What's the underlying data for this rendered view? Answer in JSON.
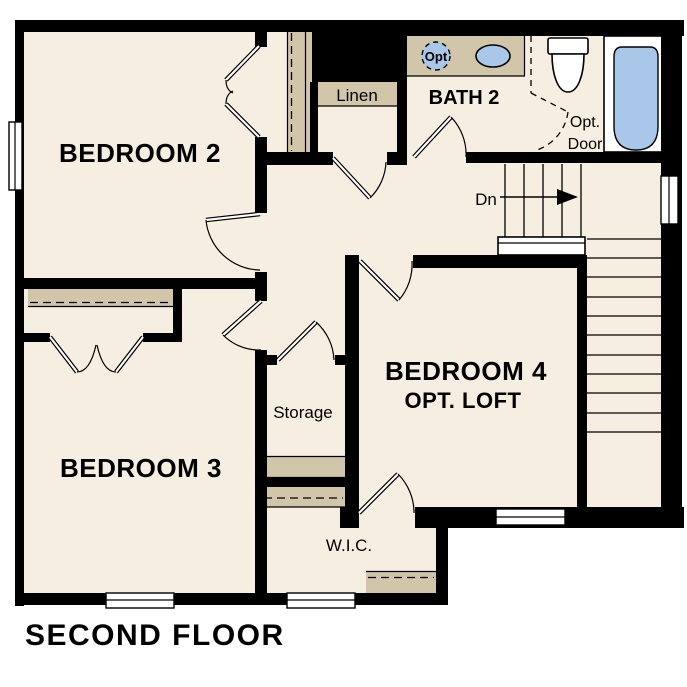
{
  "plan_title": "SECOND FLOOR",
  "rooms": {
    "bedroom2": "BEDROOM 2",
    "bedroom3": "BEDROOM 3",
    "bedroom4": "BEDROOM 4",
    "bedroom4_alt": "OPT. LOFT",
    "bath2": "BATH 2",
    "linen": "Linen",
    "storage": "Storage",
    "wic": "W.I.C."
  },
  "annotations": {
    "stair_direction": "Dn",
    "optional_door_line1": "Opt.",
    "optional_door_line2": "Door",
    "optional_sink": "Opt"
  },
  "colors": {
    "background": "#ffffff",
    "floor": "#f6eee0",
    "shelf": "#d2c6aa",
    "fixture": "#a9c8e9",
    "wall": "#000000"
  }
}
